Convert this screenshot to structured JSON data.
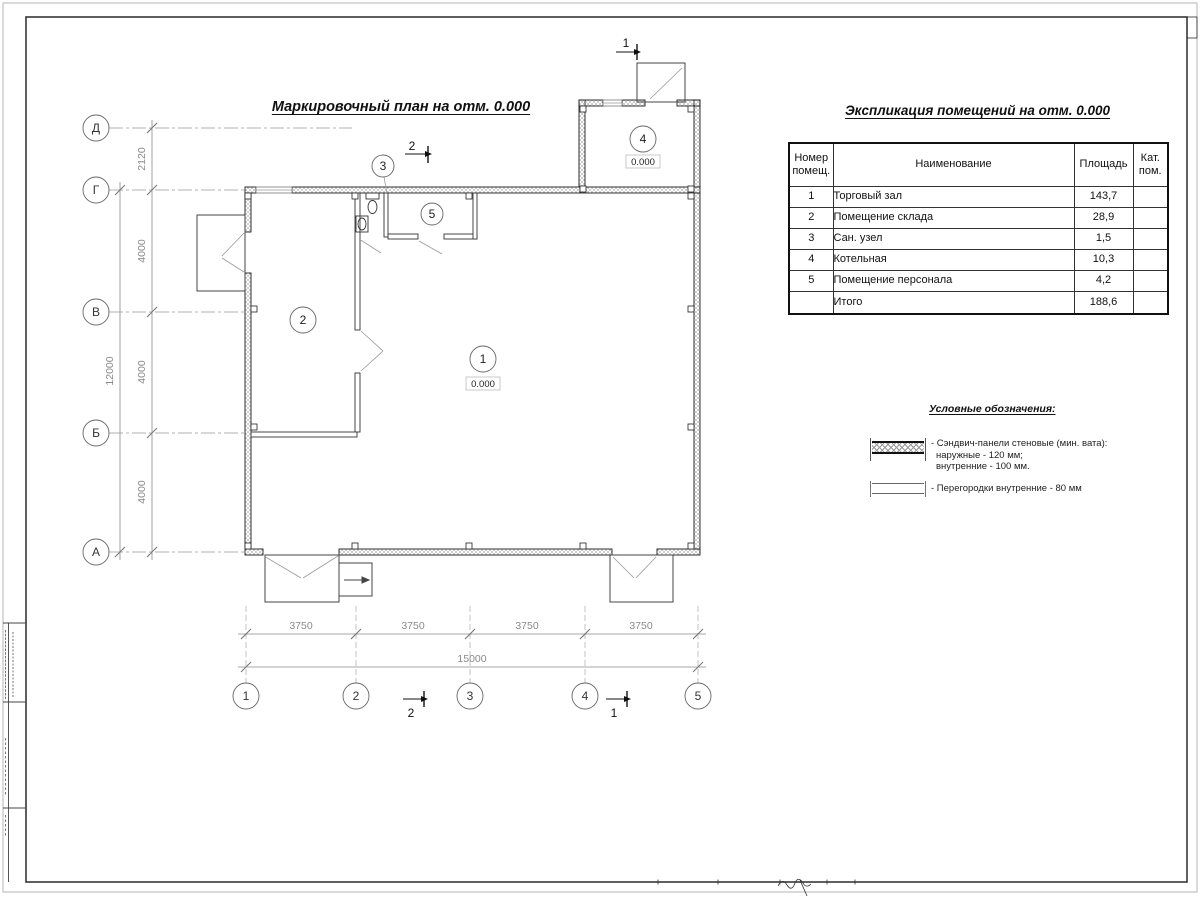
{
  "plan": {
    "title": "Маркировочный план на отм. 0.000",
    "level_mark": "0.000",
    "room_numbers": {
      "r1": "1",
      "r2": "2",
      "r3": "3",
      "r4": "4",
      "r5": "5"
    }
  },
  "axes": {
    "rows": [
      "Д",
      "Г",
      "В",
      "Б",
      "А"
    ],
    "cols": [
      "1",
      "2",
      "3",
      "4",
      "5"
    ]
  },
  "dims": {
    "left_segments": [
      "2120",
      "4000",
      "4000",
      "4000"
    ],
    "left_total": "12000",
    "bottom_segments": [
      "3750",
      "3750",
      "3750",
      "3750"
    ],
    "bottom_total": "15000"
  },
  "sections": {
    "s1": "1",
    "s2": "2"
  },
  "table": {
    "title": "Экспликация помещений на отм. 0.000",
    "headers": [
      "Номер помещ.",
      "Наименование",
      "Площадь",
      "Кат. пом."
    ],
    "rows": [
      {
        "num": "1",
        "name": "Торговый зал",
        "area": "143,7",
        "cat": ""
      },
      {
        "num": "2",
        "name": "Помещение склада",
        "area": "28,9",
        "cat": ""
      },
      {
        "num": "3",
        "name": "Сан. узел",
        "area": "1,5",
        "cat": ""
      },
      {
        "num": "4",
        "name": "Котельная",
        "area": "10,3",
        "cat": ""
      },
      {
        "num": "5",
        "name": "Помещение персонала",
        "area": "4,2",
        "cat": ""
      }
    ],
    "total_label": "Итого",
    "total_area": "188,6"
  },
  "legend": {
    "title": "Условные обозначения:",
    "sandwich_line1": "- Сэндвич-панели стеновые (мин. вата):",
    "sandwich_line2": "наружные - 120 мм;",
    "sandwich_line3": "внутренние - 100 мм.",
    "partition_line": "- Перегородки внутренние - 80 мм"
  }
}
